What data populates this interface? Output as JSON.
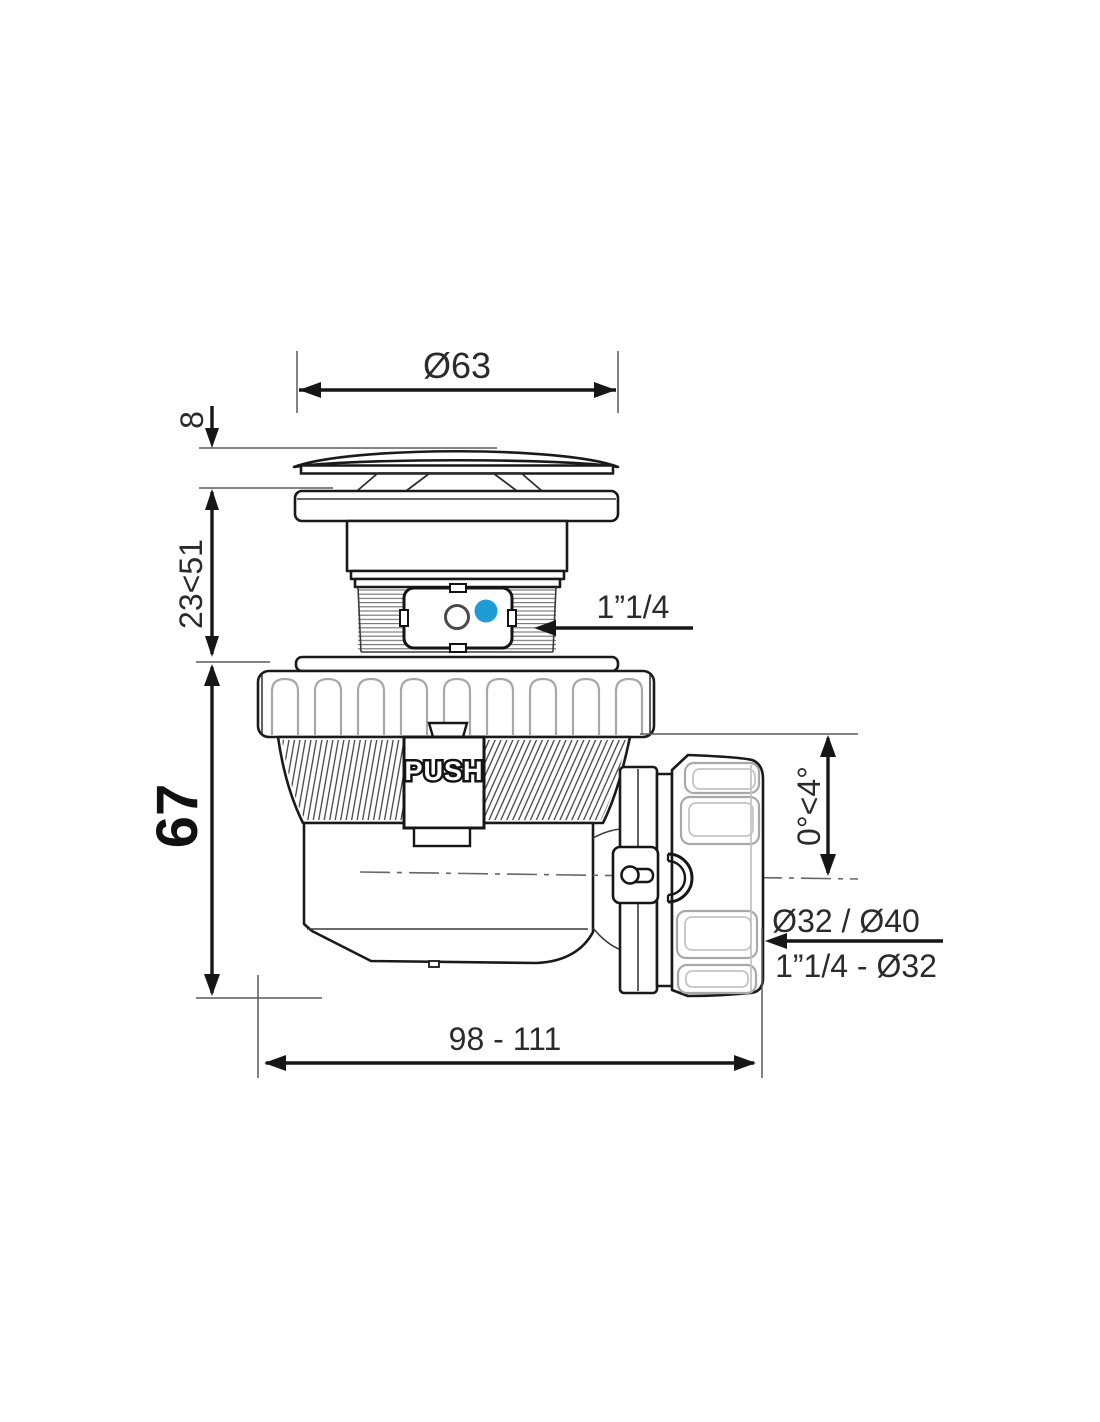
{
  "labels": {
    "diameter_top": "Ø63",
    "cap_height": "8",
    "height_adjustable": "23<51",
    "inlet_thread": "1”1/4",
    "total_height": "67",
    "outlet_angle": "0°<4°",
    "outlet_diameters": "Ø32 / Ø40",
    "outlet_thread": "1”1/4 - Ø32",
    "length_range": "98 - 111",
    "push_button": "PUSH"
  },
  "colors": {
    "accent_blue": "#1e9cd6",
    "main_line": "#1a1a1a",
    "secondary_line": "#a8a8a8",
    "background": "#ffffff"
  }
}
